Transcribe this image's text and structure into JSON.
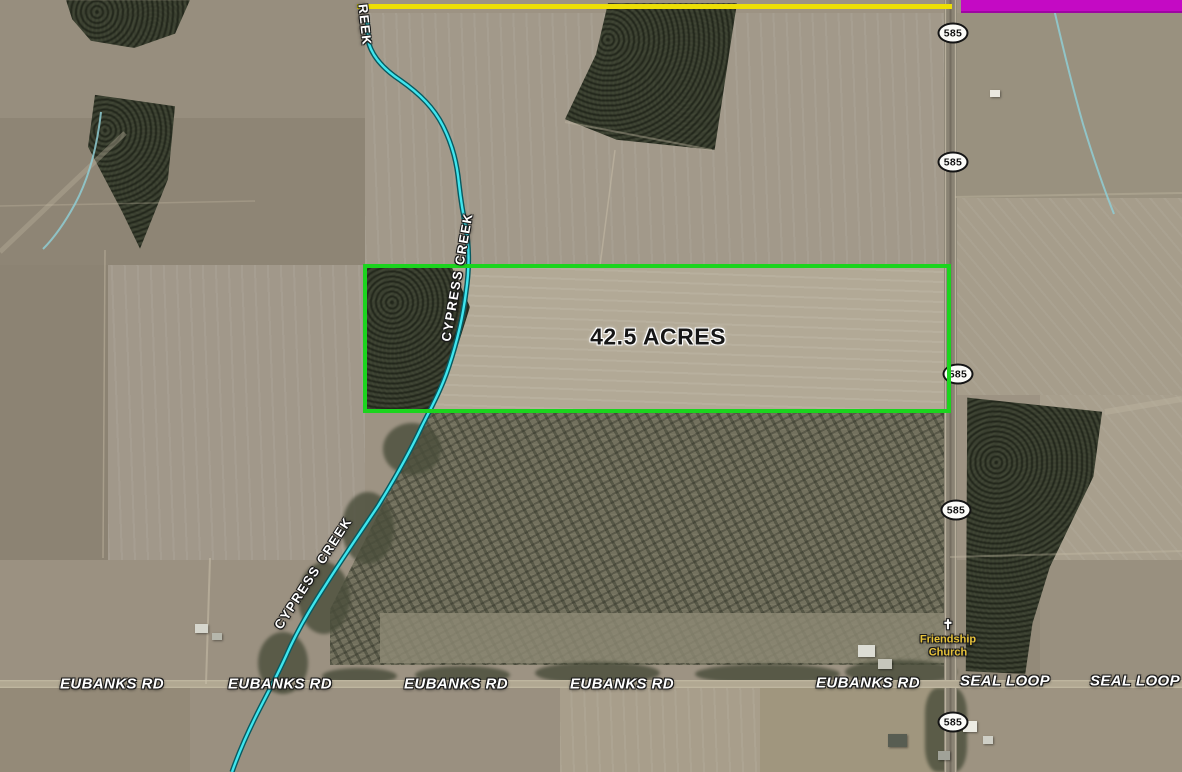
{
  "colors": {
    "parcel-green": "#1bd41e",
    "boundary-yellow": "#eddf05",
    "adjacent-magenta": "#c40ac4",
    "creek-cyan": "#3fe5ee",
    "creek-casing": "#085a60",
    "church-yellow": "#e7c33b"
  },
  "parcel": {
    "area_label": "42.5 ACRES"
  },
  "creek": {
    "label_upper": "CYPRESS CREEK",
    "label_lower": "CYPRESS CREEK",
    "label_top_partial": "REEK"
  },
  "roads": {
    "labels": [
      "EUBANKS RD",
      "EUBANKS RD",
      "EUBANKS RD",
      "EUBANKS RD",
      "EUBANKS RD",
      "SEAL LOOP",
      "SEAL LOOP"
    ]
  },
  "shields": [
    {
      "label": "585"
    },
    {
      "label": "585"
    },
    {
      "label": "585"
    },
    {
      "label": "585"
    },
    {
      "label": "585"
    }
  ],
  "church": {
    "line1": "Friendship",
    "line2": "Church",
    "cross_glyph": "✝"
  }
}
